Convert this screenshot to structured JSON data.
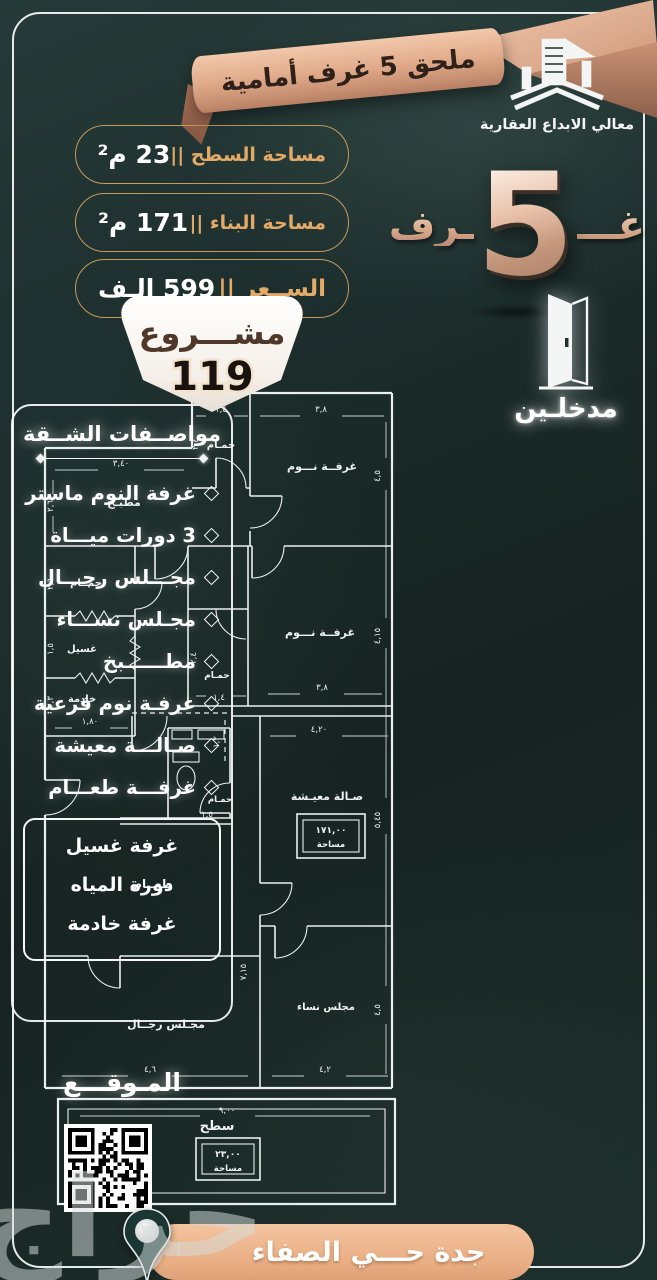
{
  "colors": {
    "background": "#1c2e2d",
    "frame": "#f0f4f3",
    "gold_accent": "#e3a967",
    "pill_border": "#c49a5e",
    "rose_ribbon": "#e2ad8d",
    "ribbon_text": "#2f2019",
    "scroll_white": "#faf6f0",
    "scroll_text": "#4f382a",
    "banner_tan": "#e9ae84",
    "pin_teal": "#1b3734",
    "plan_lines": "#e9efee"
  },
  "logo": {
    "company_name": "معالي الابداع العقارية"
  },
  "header": {
    "ribbon_title": "ملحق 5 غرف أمامية"
  },
  "rooms_badge": {
    "prefix": "غـــ",
    "count": "5",
    "suffix": "ـرف"
  },
  "entrances": {
    "label": "مدخلـين"
  },
  "stats": [
    {
      "label": "مساحة السطح ||",
      "value": "23 م²"
    },
    {
      "label": "مساحة البناء ||",
      "value": "171 م²"
    },
    {
      "label": "الســعر ||",
      "value": "599 الـف"
    }
  ],
  "project": {
    "label": "مشـــروع",
    "number": "119"
  },
  "specs": {
    "title": "مواصــفات الشــقة",
    "items": [
      "غرفة النوم ماستر",
      "3 دورات ميـــاة",
      "مجـــلس رجـــال",
      "مجـلس نســـاء",
      "مطــــــبخ",
      "غرفـة نوم فرعية",
      "صـالـــة معيشة",
      "غرفـــة طعـــام"
    ],
    "utility_box": [
      "غرفة غسيل",
      "دورة المياه",
      "غرفة خادمة"
    ]
  },
  "location": {
    "title": "المـوقـــع",
    "banner": "جدة حـــي الصفاء"
  },
  "watermark": "حراج",
  "floorplan": {
    "rooms": [
      {
        "t": "حمـام",
        "x": 201,
        "y": 62,
        "s": 10
      },
      {
        "t": "غرفــة نـــوم",
        "x": 302,
        "y": 84,
        "s": 11
      },
      {
        "t": "مطبـخ",
        "x": 104,
        "y": 120,
        "s": 11
      },
      {
        "t": "حمــام",
        "x": 66,
        "y": 200,
        "s": 10
      },
      {
        "t": "غسيل",
        "x": 62,
        "y": 266,
        "s": 10
      },
      {
        "t": "خادمة",
        "x": 62,
        "y": 316,
        "s": 10
      },
      {
        "t": "غرفــة نـــوم",
        "x": 300,
        "y": 250,
        "s": 11
      },
      {
        "t": "حمـام",
        "x": 197,
        "y": 292,
        "s": 9
      },
      {
        "t": "حمـام",
        "x": 200,
        "y": 416,
        "s": 8.5
      },
      {
        "t": "صـالة معيـشة",
        "x": 307,
        "y": 414,
        "s": 11
      },
      {
        "t": "طعــام",
        "x": 133,
        "y": 502,
        "s": 12
      },
      {
        "t": "مجـلس رجــال",
        "x": 146,
        "y": 642,
        "s": 11
      },
      {
        "t": "مجلس نساء",
        "x": 306,
        "y": 624,
        "s": 10
      },
      {
        "t": "سطح",
        "x": 197,
        "y": 744,
        "s": 13
      }
    ],
    "dims": [
      {
        "t": "١,٤",
        "x": 201,
        "y": 26
      },
      {
        "t": "٣,٨",
        "x": 301,
        "y": 26
      },
      {
        "t": "٣,٤٠",
        "x": 101,
        "y": 80
      },
      {
        "t": "٢,٦",
        "x": 33,
        "y": 120,
        "r": 1
      },
      {
        "t": "٢,٤",
        "x": 178,
        "y": 58,
        "r": 1
      },
      {
        "t": "٤,٥",
        "x": 360,
        "y": 90,
        "r": 1
      },
      {
        "t": "٢,٦",
        "x": 33,
        "y": 198,
        "r": 1
      },
      {
        "t": "١,٥",
        "x": 33,
        "y": 263,
        "r": 1
      },
      {
        "t": "٢,٣",
        "x": 33,
        "y": 316,
        "r": 1
      },
      {
        "t": "١,٨٠",
        "x": 70,
        "y": 338
      },
      {
        "t": "٤,١٥",
        "x": 360,
        "y": 250,
        "r": 1
      },
      {
        "t": "٣,٨",
        "x": 302,
        "y": 304
      },
      {
        "t": "١,٤",
        "x": 199,
        "y": 314
      },
      {
        "t": "٢,٤",
        "x": 176,
        "y": 272,
        "r": 1
      },
      {
        "t": "١,٢",
        "x": 199,
        "y": 356,
        "r": 1
      },
      {
        "t": "٤,٢٠",
        "x": 299,
        "y": 346
      },
      {
        "t": "٥,٤٥",
        "x": 360,
        "y": 434,
        "r": 1
      },
      {
        "t": "١,٥",
        "x": 187,
        "y": 431
      },
      {
        "t": "٧,١٥",
        "x": 226,
        "y": 586,
        "r": 1
      },
      {
        "t": "٤,٦",
        "x": 130,
        "y": 686
      },
      {
        "t": "٤,٢",
        "x": 305,
        "y": 686
      },
      {
        "t": "٤,٥",
        "x": 360,
        "y": 624,
        "r": 1
      },
      {
        "t": "٩,٠٠",
        "x": 207,
        "y": 727
      },
      {
        "t": "٢,٦",
        "x": 52,
        "y": 764,
        "r": 1
      }
    ],
    "area_boxes": [
      {
        "value": "١٧١,٠٠",
        "label": "مساحة",
        "x": 277,
        "y": 428,
        "w": 68,
        "h": 44
      },
      {
        "value": "٢٣,٠٠",
        "label": "مساحة",
        "x": 176,
        "y": 752,
        "w": 64,
        "h": 42
      }
    ]
  }
}
